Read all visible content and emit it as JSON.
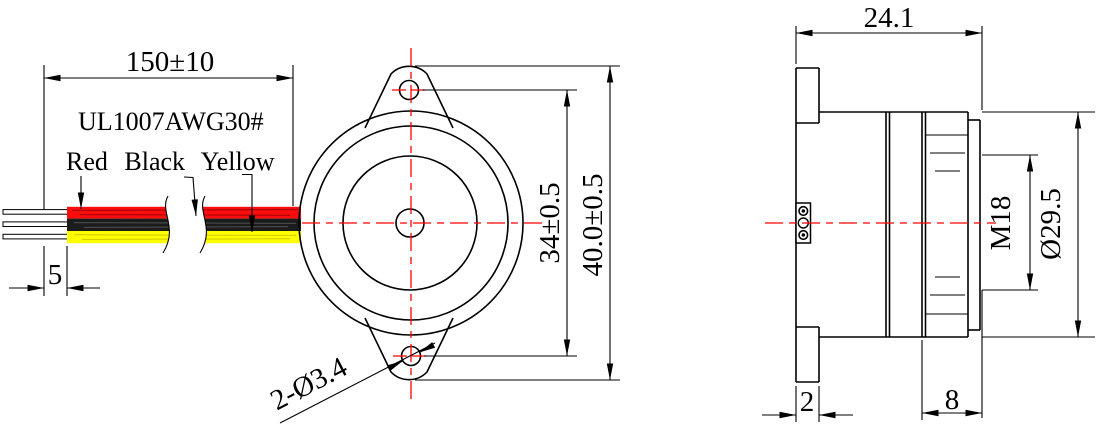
{
  "front_view": {
    "wire_length": "150±10",
    "wire_spec": "UL1007AWG30#",
    "wire_labels": "Red Black Yellow",
    "strip_length": "5",
    "hole_spacing": "34±0.5",
    "overall_height": "40.0±0.5",
    "mounting_holes": "2-Ø3.4"
  },
  "side_view": {
    "depth": "24.1",
    "thread": "M18",
    "body_diameter": "Ø29.5",
    "flange_thickness": "2",
    "thread_length": "8"
  },
  "colors": {
    "line": "#000000",
    "centerline": "#ff0000",
    "wire_red": "#fb0d0d",
    "wire_black": "#1c1c1c",
    "wire_yellow": "#ffff00"
  }
}
